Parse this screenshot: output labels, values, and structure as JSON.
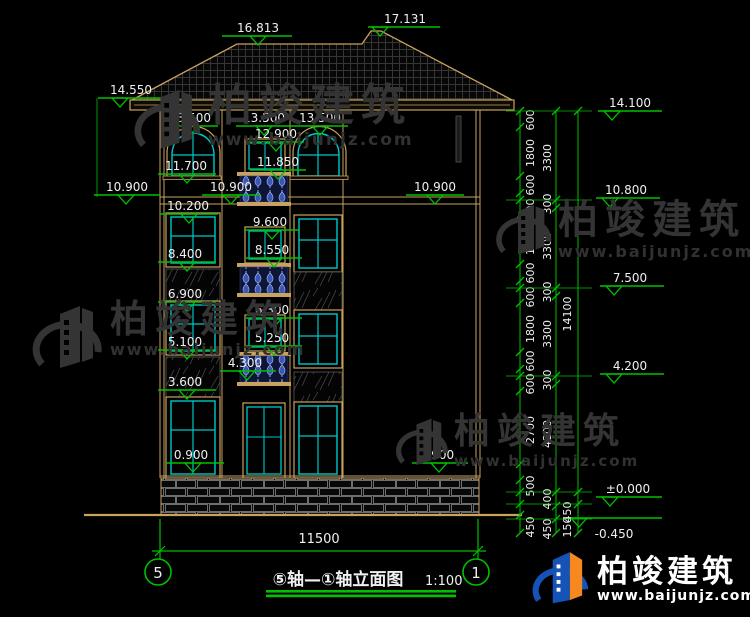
{
  "title_block": {
    "title": "⑤轴—①轴立面图",
    "scale": "1:100"
  },
  "axis_bubbles": [
    {
      "label": "5"
    },
    {
      "label": "1"
    }
  ],
  "bottom_dim": {
    "label": "11500"
  },
  "watermark": {
    "brand": "柏竣建筑",
    "site": "www.baijunjz.com"
  },
  "footer_logo": {
    "brand": "柏竣建筑",
    "site": "www.baijunjz.com"
  },
  "colors": {
    "tan": "#C8A25E",
    "green": "#00C000",
    "cyan": "#00C8C8",
    "white": "#F0F0F0",
    "baluster": "#3A57B8"
  },
  "elevation_markers": [
    {
      "label": "16.813",
      "x1": 222,
      "x2": 292,
      "y": 36,
      "t": 258,
      "tax": 258
    },
    {
      "label": "17.131",
      "x1": 368,
      "x2": 440,
      "y": 27,
      "t": 380,
      "tax": 405
    },
    {
      "label": "14.550",
      "x1": 98,
      "x2": 162,
      "y": 98,
      "t": 120,
      "tax": 131
    },
    {
      "label": "13.500",
      "x1": 162,
      "x2": 218,
      "y": 126,
      "t": 190,
      "tax": 190
    },
    {
      "label": "13.500",
      "x1": 236,
      "x2": 292,
      "y": 126,
      "t": 264,
      "tax": 264
    },
    {
      "label": "13.500",
      "x1": 292,
      "x2": 348,
      "y": 126,
      "t": 320,
      "tax": 320
    },
    {
      "label": "12.900",
      "x1": 248,
      "x2": 304,
      "y": 142,
      "t": 276,
      "tax": 276
    },
    {
      "label": "11.700",
      "x1": 158,
      "x2": 216,
      "y": 174,
      "t": 187,
      "tax": 186
    },
    {
      "label": "11.850",
      "x1": 250,
      "x2": 306,
      "y": 170,
      "t": 278,
      "tax": 278
    },
    {
      "label": "10.900",
      "x1": 94,
      "x2": 160,
      "y": 195,
      "t": 126,
      "tax": 127
    },
    {
      "label": "10.900",
      "x1": 202,
      "x2": 260,
      "y": 195,
      "t": 231,
      "tax": 231
    },
    {
      "label": "10.900",
      "x1": 406,
      "x2": 464,
      "y": 195,
      "t": 435,
      "tax": 435
    },
    {
      "label": "10.200",
      "x1": 160,
      "x2": 218,
      "y": 214,
      "t": 189,
      "tax": 188
    },
    {
      "label": "9.600",
      "x1": 244,
      "x2": 300,
      "y": 230,
      "t": 272,
      "tax": 270
    },
    {
      "label": "8.550",
      "x1": 246,
      "x2": 302,
      "y": 258,
      "t": 274,
      "tax": 272
    },
    {
      "label": "8.400",
      "x1": 158,
      "x2": 216,
      "y": 262,
      "t": 187,
      "tax": 185
    },
    {
      "label": "6.900",
      "x1": 158,
      "x2": 216,
      "y": 302,
      "t": 187,
      "tax": 185
    },
    {
      "label": "6.300",
      "x1": 246,
      "x2": 302,
      "y": 318,
      "t": 274,
      "tax": 272
    },
    {
      "label": "5.250",
      "x1": 246,
      "x2": 302,
      "y": 346,
      "t": 274,
      "tax": 272
    },
    {
      "label": "5.100",
      "x1": 158,
      "x2": 216,
      "y": 350,
      "t": 187,
      "tax": 185
    },
    {
      "label": "4.300",
      "x1": 220,
      "x2": 276,
      "y": 371,
      "t": 247,
      "tax": 245
    },
    {
      "label": "3.600",
      "x1": 158,
      "x2": 216,
      "y": 390,
      "t": 187,
      "tax": 185
    },
    {
      "label": "0.900",
      "x1": 166,
      "x2": 224,
      "y": 463,
      "t": 193,
      "tax": 191
    },
    {
      "label": "0.900",
      "x1": 412,
      "x2": 468,
      "y": 463,
      "t": 439,
      "tax": 437
    },
    {
      "label": "14.100",
      "x1": 598,
      "x2": 662,
      "y": 111,
      "t": 612,
      "tax": 630
    },
    {
      "label": "10.800",
      "x1": 596,
      "x2": 660,
      "y": 198,
      "t": 610,
      "tax": 626
    },
    {
      "label": "7.500",
      "x1": 600,
      "x2": 664,
      "y": 286,
      "t": 614,
      "tax": 630
    },
    {
      "label": "4.200",
      "x1": 600,
      "x2": 664,
      "y": 374,
      "t": 614,
      "tax": 630
    },
    {
      "label": "±0.000",
      "x1": 596,
      "x2": 662,
      "y": 497,
      "t": 610,
      "tax": 628
    },
    {
      "label": "-0.450",
      "x1": 570,
      "x2": 662,
      "y": 518,
      "t": 579,
      "tax": 614,
      "tb": true
    }
  ],
  "dim_chains": [
    {
      "x": 520,
      "y1": 111,
      "y2": 533,
      "lx": 534,
      "ticks": [
        111,
        127,
        176,
        193,
        200,
        215,
        264,
        281,
        288,
        303,
        352,
        369,
        376,
        391,
        464,
        480,
        492,
        504,
        515,
        533
      ],
      "labels": [
        {
          "t": "600",
          "y": 120
        },
        {
          "t": "1800",
          "y": 153
        },
        {
          "t": "600",
          "y": 185
        },
        {
          "t": "600",
          "y": 209
        },
        {
          "t": "1800",
          "y": 241
        },
        {
          "t": "600",
          "y": 273
        },
        {
          "t": "600",
          "y": 297
        },
        {
          "t": "1800",
          "y": 329
        },
        {
          "t": "600",
          "y": 361
        },
        {
          "t": "600",
          "y": 384
        },
        {
          "t": "2700",
          "y": 430
        },
        {
          "t": "500",
          "y": 486
        },
        {
          "t": "450",
          "y": 527
        }
      ]
    },
    {
      "x": 556,
      "y1": 111,
      "y2": 533,
      "lx": 551,
      "ticks": [
        111,
        200,
        208,
        288,
        296,
        376,
        384,
        492,
        506,
        519,
        533
      ],
      "labels": [
        {
          "t": "3300",
          "y": 158
        },
        {
          "t": "300",
          "y": 204
        },
        {
          "t": "3300",
          "y": 246
        },
        {
          "t": "300",
          "y": 292
        },
        {
          "t": "3300",
          "y": 334
        },
        {
          "t": "300",
          "y": 380
        },
        {
          "t": "4200",
          "y": 434
        },
        {
          "t": "400",
          "y": 499
        },
        {
          "t": "450",
          "y": 529
        }
      ]
    },
    {
      "x": 578,
      "y1": 111,
      "y2": 533,
      "lx": 571,
      "ticks": [
        111,
        492,
        504,
        533
      ],
      "labels": [
        {
          "t": "14100",
          "y": 314
        },
        {
          "t": "450",
          "y": 512
        },
        {
          "t": "150",
          "y": 527
        }
      ]
    }
  ],
  "chain_horizontals": [
    111,
    200,
    288,
    376,
    492,
    504,
    519
  ]
}
